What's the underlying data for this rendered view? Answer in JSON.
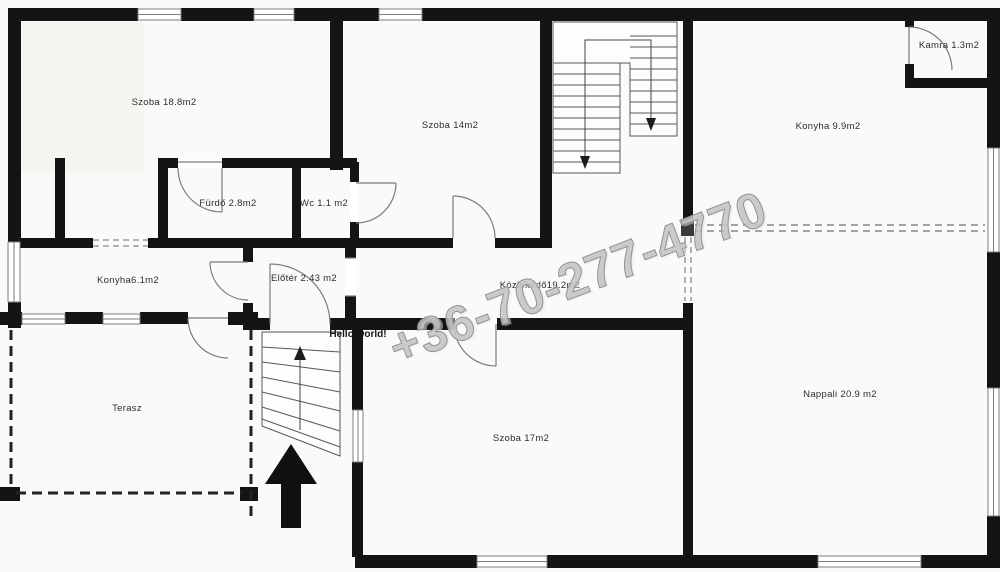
{
  "floorplan": {
    "watermark": "+36-70-277-4770",
    "annotation": "Hello world!",
    "rooms": [
      {
        "id": "szoba-18",
        "label": "Szoba 18.8m2"
      },
      {
        "id": "szoba-14",
        "label": "Szoba 14m2"
      },
      {
        "id": "kamra",
        "label": "Kamra 1.3m2"
      },
      {
        "id": "konyha-9",
        "label": "Konyha 9.9m2"
      },
      {
        "id": "furdo",
        "label": "Fürdő 2.8m2"
      },
      {
        "id": "wc",
        "label": "Wc 1.1 m2"
      },
      {
        "id": "konyha-6",
        "label": "Konyha6.1m2"
      },
      {
        "id": "eloter",
        "label": "Előtér 2.43 m2"
      },
      {
        "id": "kozlekedo",
        "label": "Közlekedő19.2m2"
      },
      {
        "id": "terasz",
        "label": "Terasz"
      },
      {
        "id": "szoba-17",
        "label": "Szoba 17m2"
      },
      {
        "id": "nappali",
        "label": "Nappali 20.9 m2"
      }
    ],
    "colors": {
      "wall": "#141414",
      "thin_line": "#777777",
      "watermark": "#c3c3c3"
    }
  }
}
